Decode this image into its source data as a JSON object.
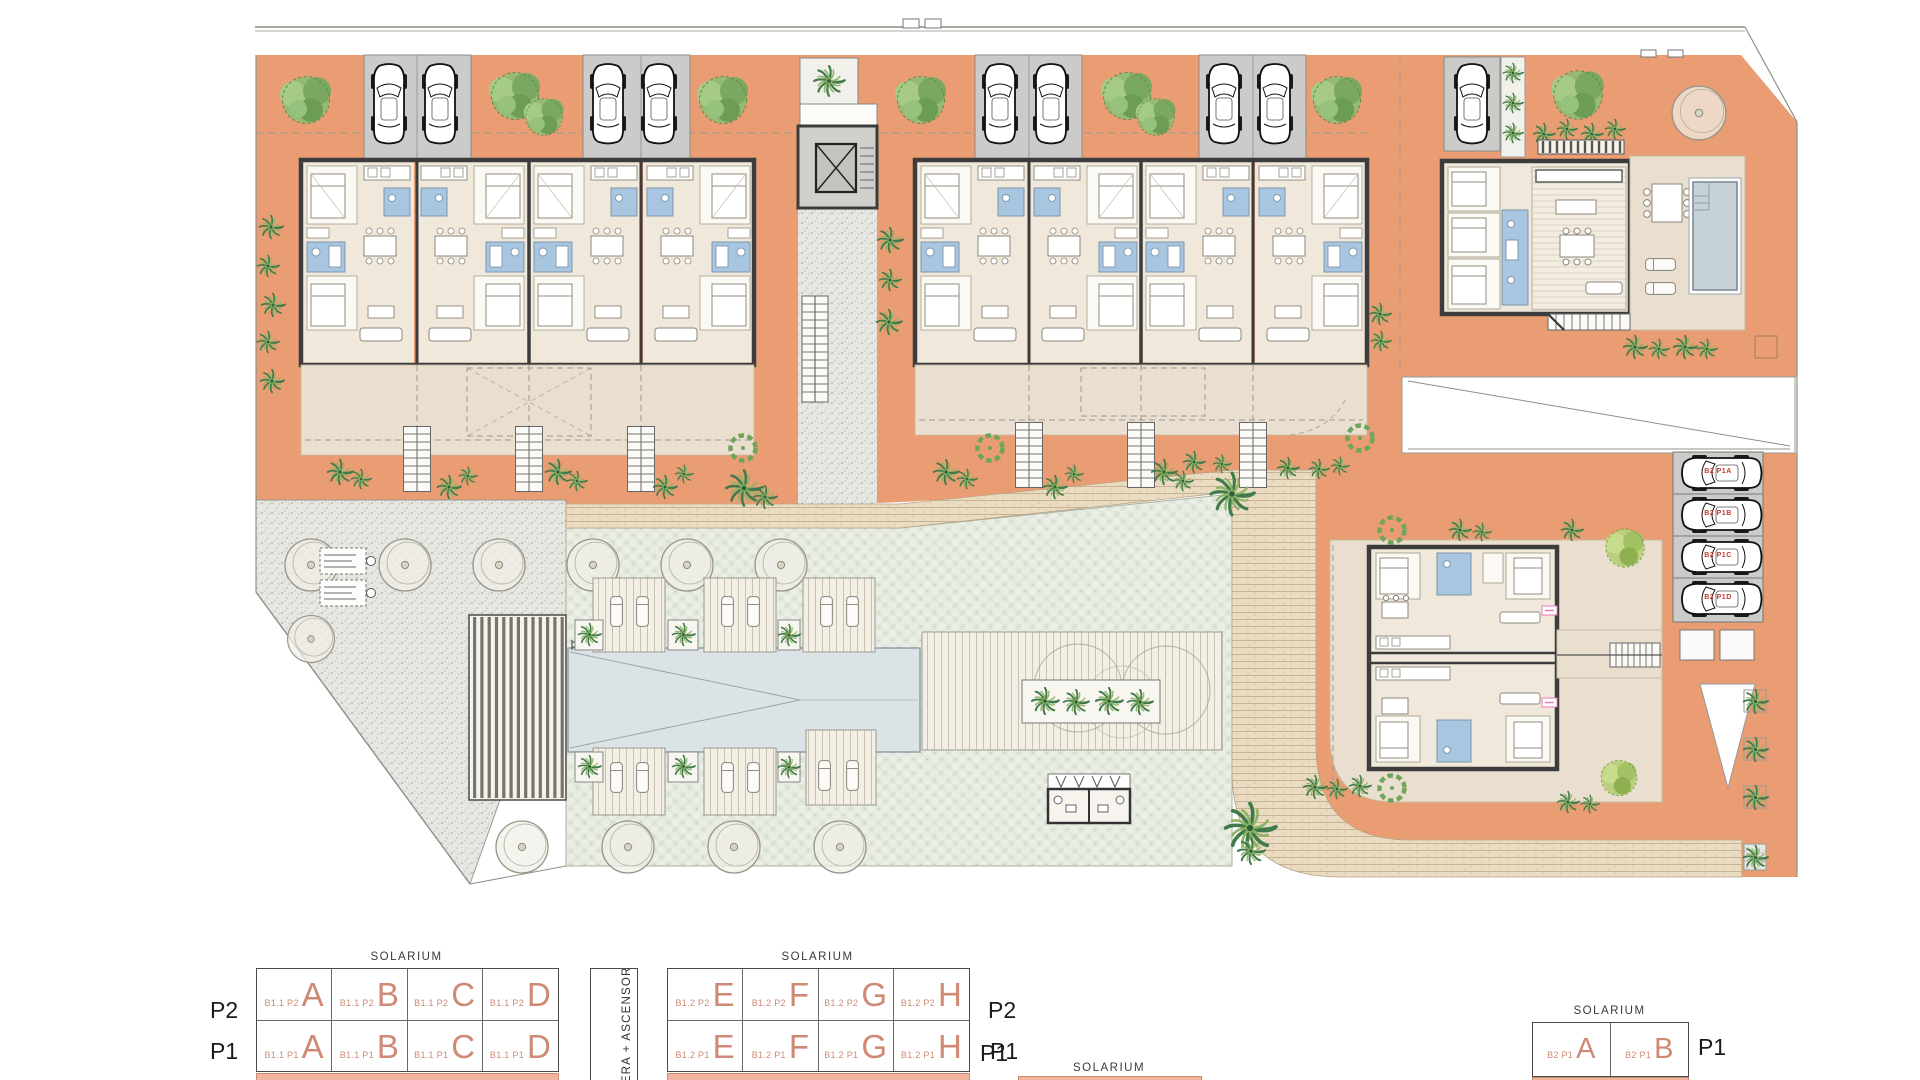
{
  "legend": {
    "stair_label": "ESCALERA + ASCENSOR",
    "block1": {
      "solarium": "SOLARIUM",
      "rows": [
        {
          "level": "P2",
          "cells": [
            {
              "code": "B1.1 P2",
              "letter": "A"
            },
            {
              "code": "B1.1 P2",
              "letter": "B"
            },
            {
              "code": "B1.1 P2",
              "letter": "C"
            },
            {
              "code": "B1.1 P2",
              "letter": "D"
            }
          ]
        },
        {
          "level": "P1",
          "cells": [
            {
              "code": "B1.1 P1",
              "letter": "A"
            },
            {
              "code": "B1.1 P1",
              "letter": "B"
            },
            {
              "code": "B1.1 P1",
              "letter": "C"
            },
            {
              "code": "B1.1 P1",
              "letter": "D"
            }
          ]
        }
      ]
    },
    "block2": {
      "solarium": "SOLARIUM",
      "rows": [
        {
          "level": "P2",
          "cells": [
            {
              "code": "B1.2 P2",
              "letter": "E"
            },
            {
              "code": "B1.2 P2",
              "letter": "F"
            },
            {
              "code": "B1.2 P2",
              "letter": "G"
            },
            {
              "code": "B1.2 P2",
              "letter": "H"
            }
          ]
        },
        {
          "level": "P1",
          "cells": [
            {
              "code": "B1.2 P1",
              "letter": "E"
            },
            {
              "code": "B1.2 P1",
              "letter": "F"
            },
            {
              "code": "B1.2 P1",
              "letter": "G"
            },
            {
              "code": "B1.2 P1",
              "letter": "H"
            }
          ]
        }
      ]
    },
    "block3": {
      "solarium": "SOLARIUM",
      "row_level": "P1",
      "cells": [
        {
          "code": "B2 P1",
          "letter": "A"
        },
        {
          "code": "B2 P1",
          "letter": "B"
        }
      ]
    },
    "bottom": {
      "level": "P1",
      "solarium": "SOLARIUM"
    }
  },
  "parking": {
    "labels": [
      "B2 P1A",
      "B2 P1B",
      "B2 P1C",
      "B2 P1D"
    ]
  },
  "colors": {
    "terracotta": "#EA9C72",
    "salmon": "#F2B49C",
    "terrace": "#EADFCE",
    "floor": "#F0E8DA",
    "wall": "#3C3C3C",
    "bath_blue": "#A8C6E0",
    "pool": "#DCE3E6",
    "villa_pool": "#C6D1D8",
    "lawn": "#EAEEE5",
    "stipple": "#E6E6E2",
    "tan_path": "#EADCC3",
    "parking_gray": "#CBCBCA",
    "legend_red": "#CF8A75",
    "label_red": "#C23B2E",
    "pink": "#E878B6",
    "tree_green": "#86B06A",
    "palm_green": "#3F7B4B"
  }
}
